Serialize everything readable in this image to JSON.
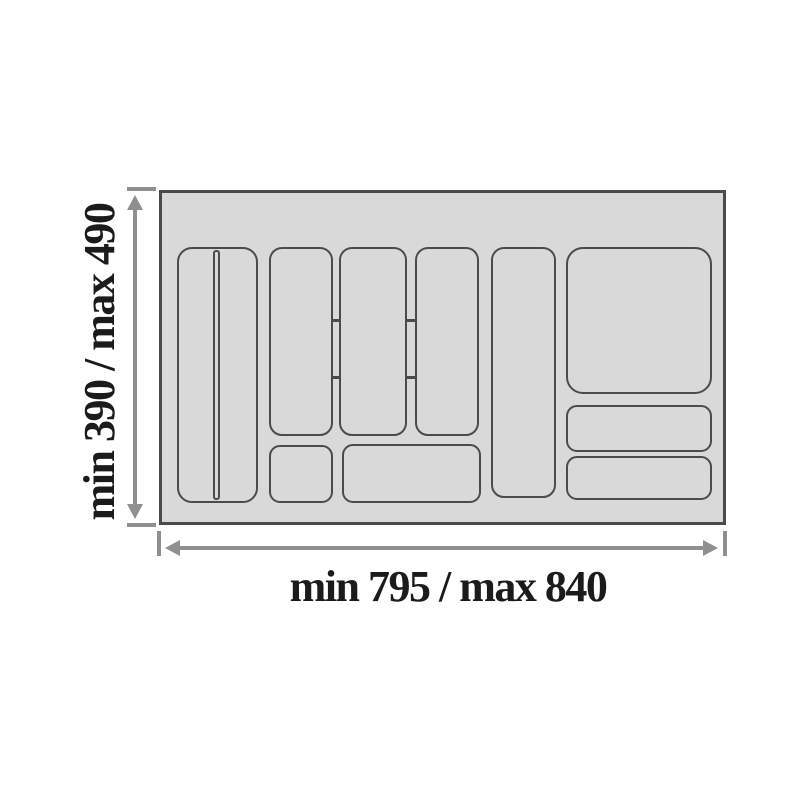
{
  "diagram": {
    "title": "cutlery tray insert dimension drawing",
    "dimensions": {
      "height_label": "min 390 / max 490",
      "width_label": "min 795 / max 840"
    },
    "colors": {
      "background": "#ffffff",
      "tray_fill": "#d9d9d9",
      "tray_border": "#4b4b4b",
      "compartment_line": "#4b4b4b",
      "dimension_line": "#8f8f8f",
      "label_text": "#1b1b1b"
    },
    "tray": {
      "x": 159,
      "y": 190,
      "w": 567,
      "h": 335
    },
    "compartments": [
      {
        "name": "compartment-knife-tall",
        "x": 177,
        "y": 247,
        "w": 81,
        "h": 256,
        "r": 15
      },
      {
        "name": "compartment-col2-top",
        "x": 269,
        "y": 247,
        "w": 64,
        "h": 189,
        "r": 13
      },
      {
        "name": "compartment-col2-bottom",
        "x": 269,
        "y": 445,
        "w": 64,
        "h": 58,
        "r": 11
      },
      {
        "name": "compartment-col3-top",
        "x": 339,
        "y": 247,
        "w": 68,
        "h": 189,
        "r": 13
      },
      {
        "name": "compartment-col4-top",
        "x": 415,
        "y": 247,
        "w": 64,
        "h": 189,
        "r": 13
      },
      {
        "name": "compartment-center-bottom-wide",
        "x": 342,
        "y": 444,
        "w": 139,
        "h": 59,
        "r": 11
      },
      {
        "name": "compartment-col5-tall",
        "x": 491,
        "y": 247,
        "w": 65,
        "h": 251,
        "r": 13
      },
      {
        "name": "compartment-right-large",
        "x": 566,
        "y": 247,
        "w": 146,
        "h": 147,
        "r": 17
      },
      {
        "name": "compartment-right-middle",
        "x": 566,
        "y": 405,
        "w": 146,
        "h": 47,
        "r": 11
      },
      {
        "name": "compartment-right-bottom",
        "x": 566,
        "y": 456,
        "w": 146,
        "h": 44,
        "r": 11
      }
    ],
    "knife_slot": {
      "x": 213,
      "y": 250,
      "w": 7,
      "h": 250,
      "r": 3
    },
    "connectors": [
      {
        "x": 331,
        "y": 319,
        "w": 10,
        "h": 3
      },
      {
        "x": 331,
        "y": 376,
        "w": 10,
        "h": 3
      },
      {
        "x": 405,
        "y": 319,
        "w": 12,
        "h": 3
      },
      {
        "x": 405,
        "y": 376,
        "w": 12,
        "h": 3
      }
    ]
  }
}
